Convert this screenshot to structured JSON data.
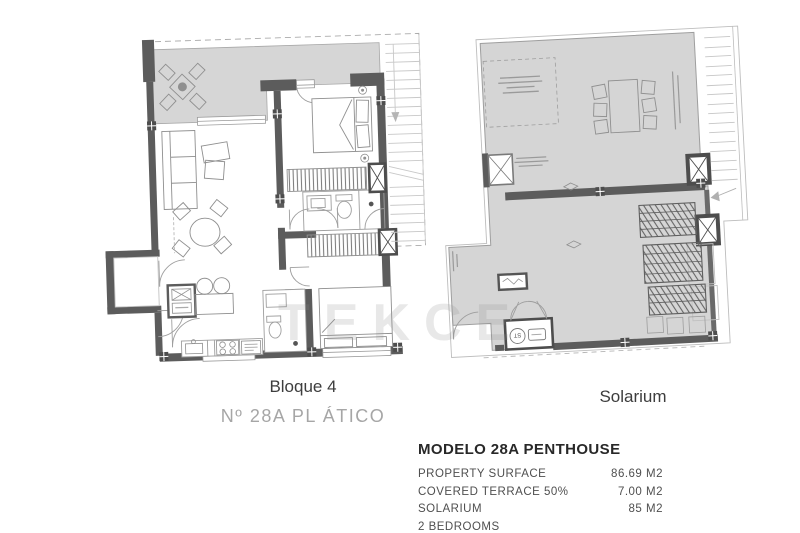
{
  "watermark": "TEKCE",
  "plans": {
    "bloque4": {
      "title": "Bloque 4",
      "subtitle": "Nº 28A PL ÁTICO"
    },
    "solarium": {
      "title": "Solarium",
      "st_label": "ST"
    }
  },
  "info": {
    "title": "MODELO 28A PENTHOUSE",
    "rows": [
      {
        "label": "PROPERTY SURFACE",
        "value": "86.69 M2"
      },
      {
        "label": "COVERED TERRACE 50%",
        "value": "7.00 M2"
      },
      {
        "label": "SOLARIUM",
        "value": "85 M2"
      },
      {
        "label": "2 BEDROOMS",
        "value": ""
      }
    ]
  },
  "colors": {
    "wall": "#5c5c5c",
    "terrace_fill": "#d6d6d6",
    "solarium_fill": "#d5d5d5",
    "furniture_line": "#8f8f8f",
    "title_text": "#3d3d3d",
    "subtitle_text": "#a6a6a6",
    "info_text": "#4f4f4f"
  }
}
